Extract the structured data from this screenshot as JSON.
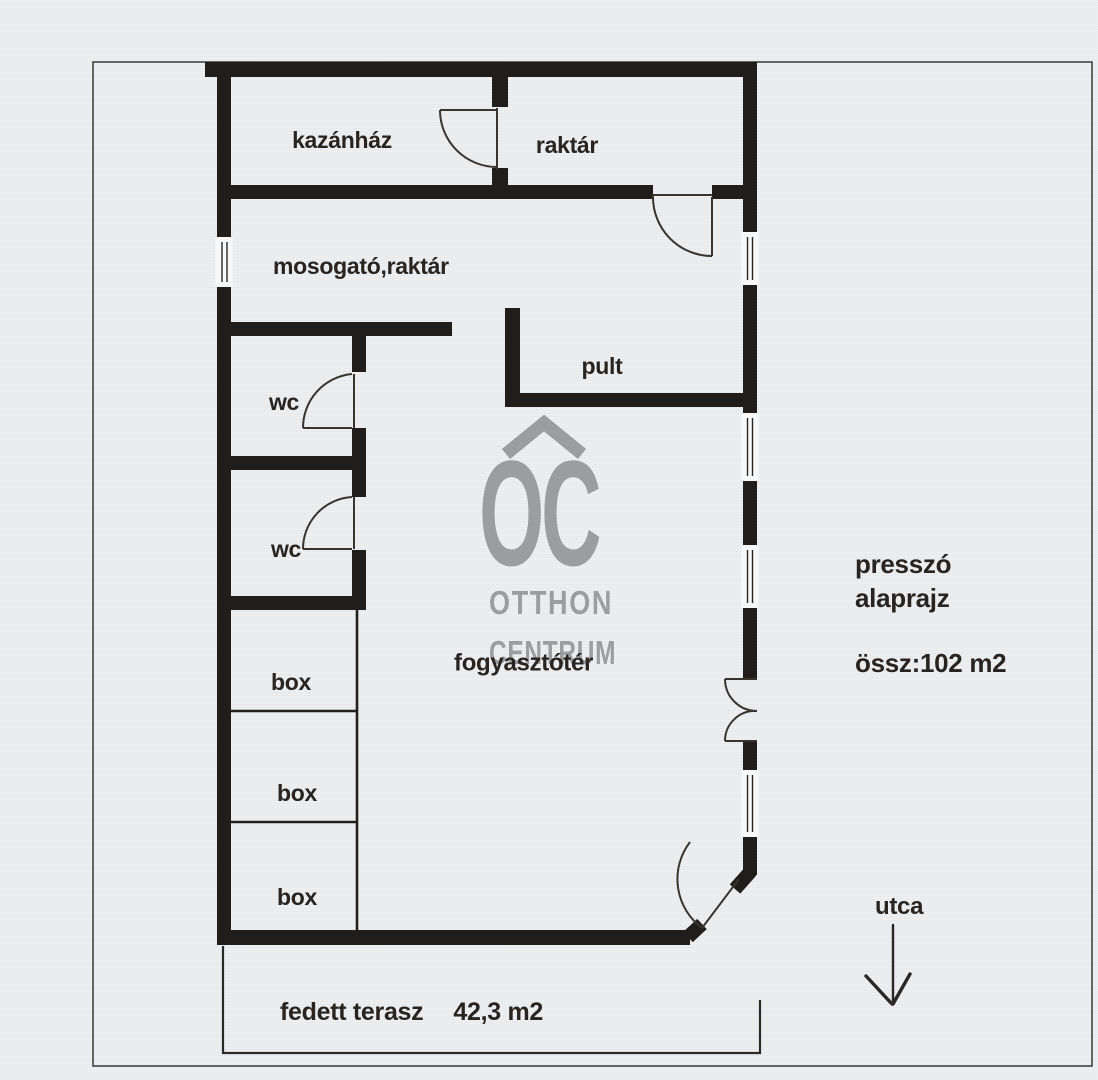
{
  "page": {
    "paper_color": "#edeff1",
    "wall_color": "#211d1a",
    "text_color": "#292420",
    "watermark_color": "#9b9da0"
  },
  "rooms": {
    "kazanhaz": "kazánház",
    "raktar": "raktár",
    "mosogato": "mosogató,raktár",
    "wc1": "wc",
    "wc2": "wc",
    "pult": "pult",
    "fogyasztoter": "fogyasztótér",
    "box1": "box",
    "box2": "box",
    "box3": "box"
  },
  "annotations": {
    "title_line1": "presszó",
    "title_line2": "alaprajz",
    "total_area": "össz:102 m2",
    "street": "utca",
    "terrace_label": "fedett terasz",
    "terrace_area": "42,3 m2"
  },
  "watermark": {
    "monogram": "OC",
    "line1": "OTTHON",
    "line2": "CENTRUM"
  }
}
